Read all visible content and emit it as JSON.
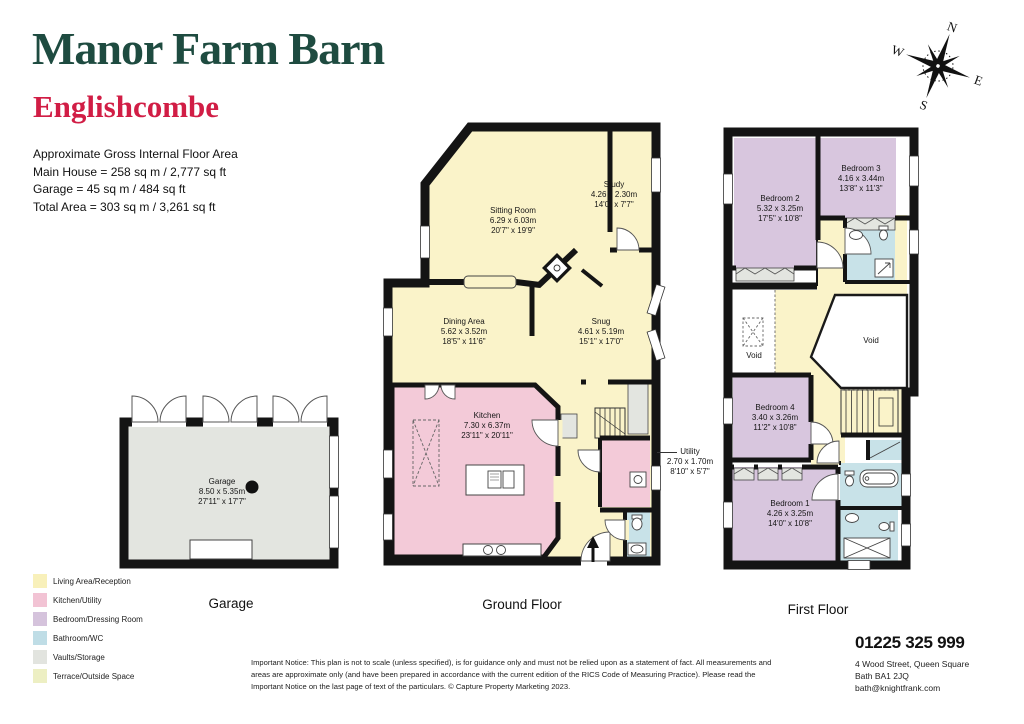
{
  "header": {
    "title": "Manor Farm Barn",
    "subtitle": "Englishcombe",
    "area_lines": [
      "Approximate Gross Internal Floor Area",
      "Main House = 258 sq m / 2,777 sq ft",
      "Garage = 45 sq m / 484 sq ft",
      "Total Area = 303 sq m / 3,261 sq ft"
    ]
  },
  "compass": {
    "n": "N",
    "e": "E",
    "s": "S",
    "w": "W"
  },
  "floors": {
    "garage": {
      "title": "Garage",
      "rooms": [
        {
          "name": "Garage",
          "metric": "8.50 x 5.35m",
          "imperial": "27'11\" x 17'7\""
        }
      ]
    },
    "ground": {
      "title": "Ground Floor",
      "rooms": [
        {
          "name": "Sitting Room",
          "metric": "6.29 x 6.03m",
          "imperial": "20'7\" x 19'9\""
        },
        {
          "name": "Study",
          "metric": "4.26 x 2.30m",
          "imperial": "14'0\" x 7'7\""
        },
        {
          "name": "Dining Area",
          "metric": "5.62 x 3.52m",
          "imperial": "18'5\" x 11'6\""
        },
        {
          "name": "Snug",
          "metric": "4.61 x 5.19m",
          "imperial": "15'1\" x 17'0\""
        },
        {
          "name": "Kitchen",
          "metric": "7.30 x 6.37m",
          "imperial": "23'11\" x 20'11\""
        },
        {
          "name": "Utility",
          "metric": "2.70 x 1.70m",
          "imperial": "8'10\" x 5'7\""
        }
      ]
    },
    "first": {
      "title": "First Floor",
      "rooms": [
        {
          "name": "Bedroom 2",
          "metric": "5.32 x 3.25m",
          "imperial": "17'5\" x 10'8\""
        },
        {
          "name": "Bedroom 3",
          "metric": "4.16 x 3.44m",
          "imperial": "13'8\" x 11'3\""
        },
        {
          "name": "Bedroom 4",
          "metric": "3.40 x 3.26m",
          "imperial": "11'2\" x 10'8\""
        },
        {
          "name": "Bedroom 1",
          "metric": "4.26 x 3.25m",
          "imperial": "14'0\" x 10'8\""
        }
      ],
      "void_left": "Void",
      "void_right": "Void"
    }
  },
  "legend": [
    {
      "label": "Living Area/Reception",
      "color": "#f8f0ba"
    },
    {
      "label": "Kitchen/Utility",
      "color": "#f2c3d4"
    },
    {
      "label": "Bedroom/Dressing Room",
      "color": "#d5c3dc"
    },
    {
      "label": "Bathroom/WC",
      "color": "#bfdde6"
    },
    {
      "label": "Vaults/Storage",
      "color": "#e2e4df"
    },
    {
      "label": "Terrace/Outside Space",
      "color": "#edefc3"
    }
  ],
  "footer": {
    "notice": "Important Notice: This plan is not to scale (unless specified), is for guidance only and must not be relied upon as a statement of fact. All measurements and areas are approximate only (and have been prepared in accordance with the current edition of the RICS Code of Measuring Practice). Please read the Important Notice on the last page of text of the particulars. © Capture Property Marketing 2023.",
    "phone": "01225 325 999",
    "address_line1": "4 Wood Street, Queen Square",
    "address_line2": "Bath BA1 2JQ",
    "email": "bath@knightfrank.com"
  },
  "palette": {
    "wall": "#141414",
    "living": "#faf3c9",
    "kitchen_utility": "#f3cad8",
    "bedroom": "#d8c6de",
    "bathroom": "#c8e2e8",
    "storage": "#e3e5e0",
    "title_green": "#1e4b40",
    "subtitle_red": "#d11d45"
  }
}
